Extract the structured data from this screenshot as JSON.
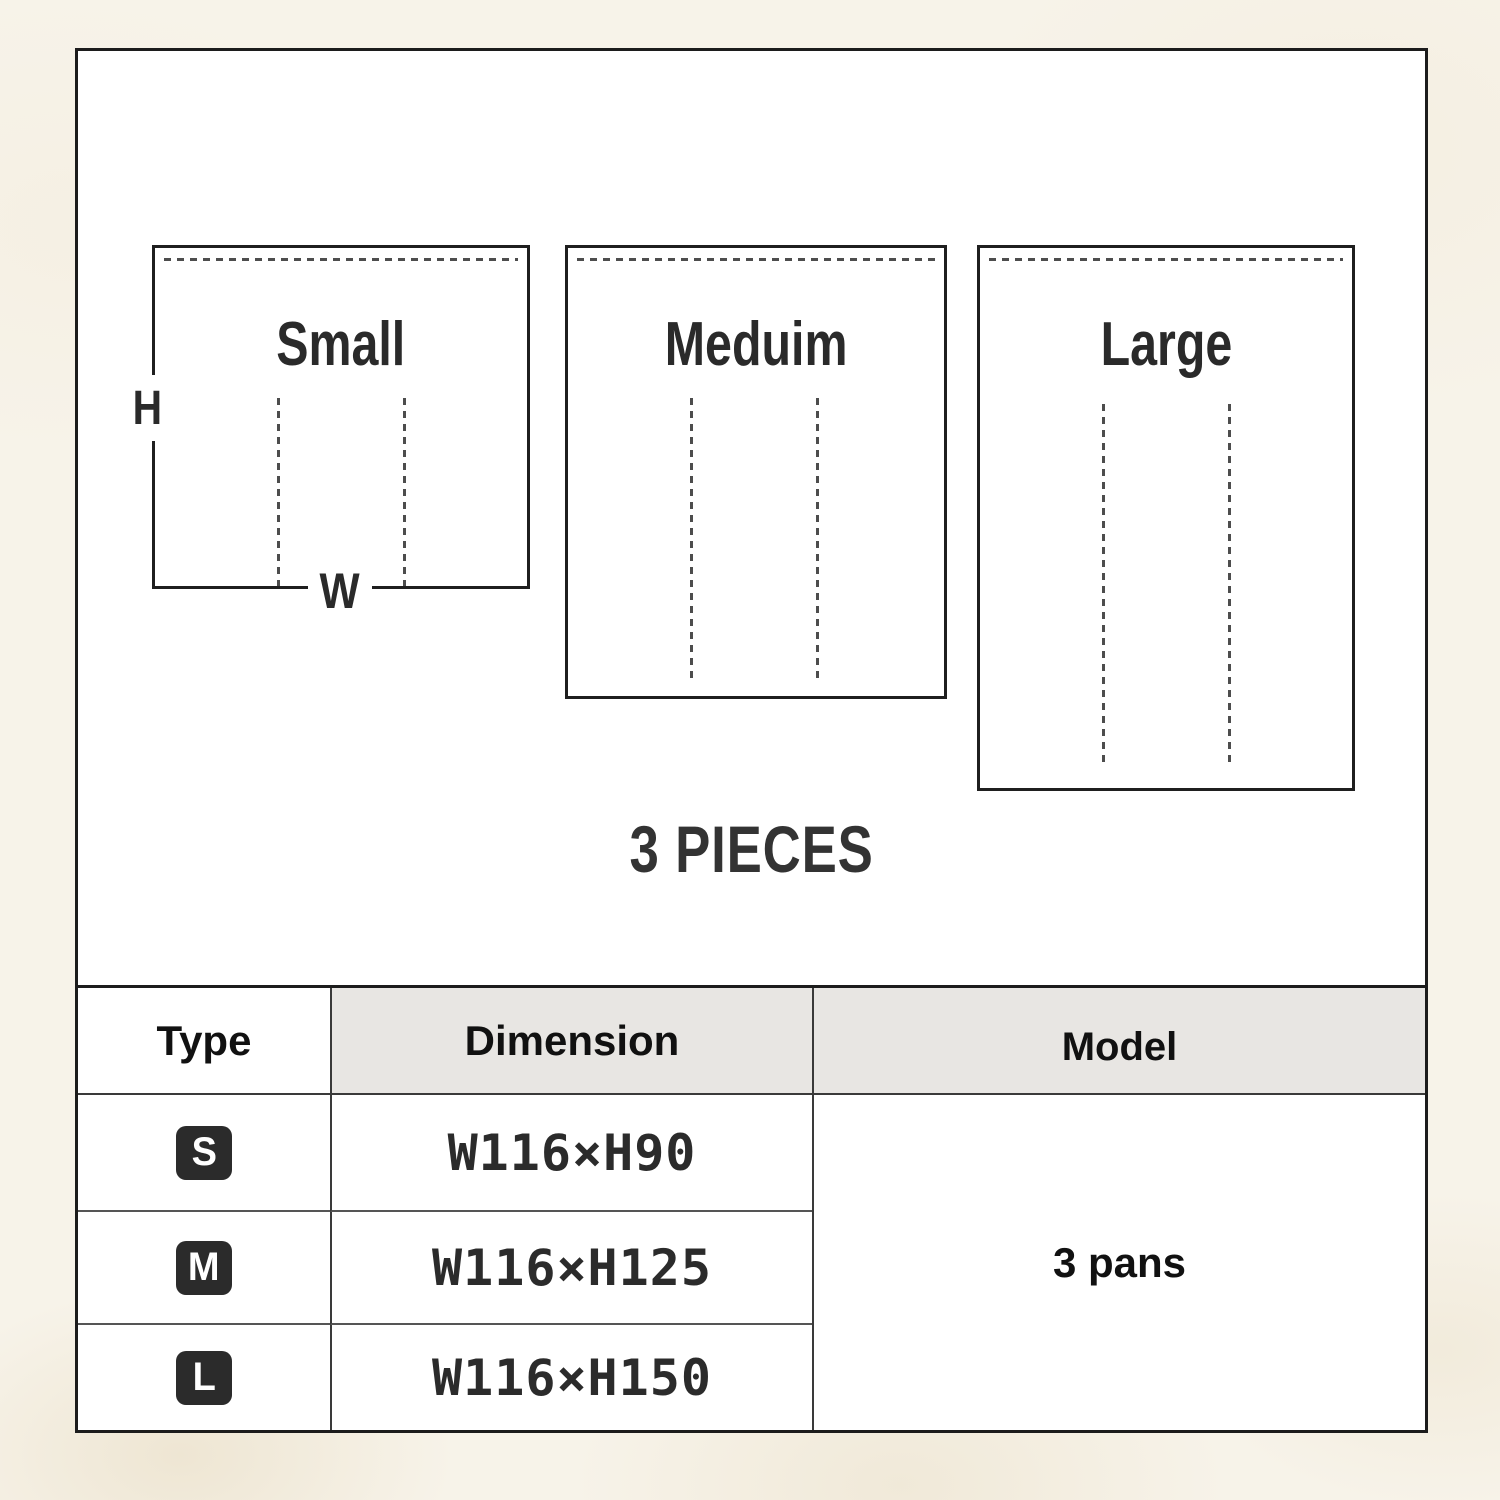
{
  "diagram": {
    "boxes": [
      {
        "size": "small",
        "label": "Small"
      },
      {
        "size": "medium",
        "label": "Meduim"
      },
      {
        "size": "large",
        "label": "Large"
      }
    ],
    "height_label": "H",
    "width_label": "W",
    "pieces_label": "3 PIECES"
  },
  "table": {
    "headers": {
      "type": "Type",
      "dimension": "Dimension",
      "model": "Model"
    },
    "rows": [
      {
        "type_badge": "S",
        "dimension": "W116×H90"
      },
      {
        "type_badge": "M",
        "dimension": "W116×H125"
      },
      {
        "type_badge": "L",
        "dimension": "W116×H150"
      }
    ],
    "model_value": "3 pans"
  },
  "colors": {
    "background": "#f7f3e9",
    "frame_border": "#1c1c1c",
    "dashed_line": "#4d4d4d",
    "header_bg": "#e8e6e3",
    "badge_bg": "#2b2b2b",
    "text": "#2a2a2a"
  }
}
